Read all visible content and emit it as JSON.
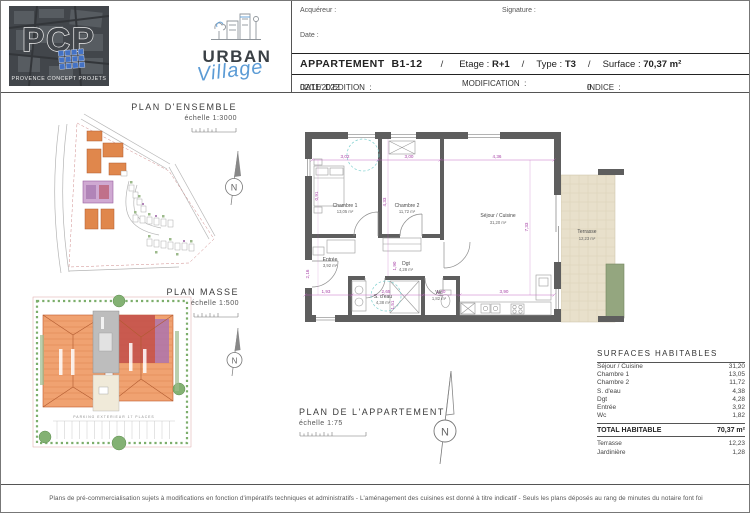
{
  "header": {
    "acquereur_label": "Acquéreur :",
    "signature_label": "Signature :",
    "date_label": "Date :",
    "apt": {
      "label": "APPARTEMENT  B1-12",
      "sep": "/",
      "etage_label": "Etage : ",
      "etage_value": "R+1",
      "type_label": "Type : ",
      "type_value": "T3",
      "surface_label": "Surface : ",
      "surface_value": "70,37 m²"
    },
    "edition": {
      "date_edition_label": "DATE  D'EDITION  : ",
      "date_edition_value": "02/11/2022",
      "modification_label": "MODIFICATION  :",
      "indice_label": "INDICE  : ",
      "indice_value": "0"
    }
  },
  "logos": {
    "pcp": {
      "letters": "PCP",
      "subtitle": "PROVENCE CONCEPT PROJETS"
    },
    "urban": {
      "line1": "URBAN",
      "line2": "Village"
    }
  },
  "plans": {
    "north_letter": "N",
    "ensemble": {
      "title": "PLAN D'ENSEMBLE",
      "scale": "échelle  1:3000"
    },
    "masse": {
      "title": "PLAN MASSE",
      "scale": "échelle  1:500",
      "parking": "PARKING  EXTERIEUR  17  PLACES"
    },
    "appartement": {
      "title": "PLAN DE L'APPARTEMENT",
      "scale": "échelle  1:75"
    }
  },
  "floorplan": {
    "rooms": [
      {
        "name": "Chambre 1",
        "area": "13,05 m²"
      },
      {
        "name": "Chambre 2",
        "area": "11,72 m²"
      },
      {
        "name": "Séjour / Cuisine",
        "area": "31,20 m²"
      },
      {
        "name": "Entrée",
        "area": "3,92 m²"
      },
      {
        "name": "Dgt",
        "area": "4,28 m²"
      },
      {
        "name": "S. d'eau",
        "area": "4,38 m²"
      },
      {
        "name": "Wc",
        "area": "1,82 m²"
      },
      {
        "name": "Terrasse",
        "area": "12,23 m²"
      }
    ],
    "dims": {
      "top": [
        "3,02",
        "3,00",
        "4,36"
      ],
      "bottom": [
        "1,93",
        "2,65",
        "1,40",
        "3,90"
      ],
      "vertical": [
        "0,91",
        "2,16",
        "1,90",
        "4,33",
        "1,51",
        "7,33"
      ]
    }
  },
  "surfaces_table": {
    "title": "SURFACES HABITABLES",
    "rows": [
      {
        "label": "Séjour / Cuisine",
        "value": "31,20"
      },
      {
        "label": "Chambre 1",
        "value": "13,05"
      },
      {
        "label": "Chambre 2",
        "value": "11,72"
      },
      {
        "label": "S. d'eau",
        "value": "4,38"
      },
      {
        "label": "Dgt",
        "value": "4,28"
      },
      {
        "label": "Entrée",
        "value": "3,92"
      },
      {
        "label": "Wc",
        "value": "1,82"
      }
    ],
    "total_label": "TOTAL HABITABLE",
    "total_value": "70,37 m²",
    "annex": [
      {
        "label": "Terrasse",
        "value": "12,23"
      },
      {
        "label": "Jardinière",
        "value": "1,28"
      }
    ]
  },
  "footer": {
    "disclaimer": "Plans de pré-commercialisation sujets à modifications en fonction d'impératifs techniques et administratifs  -  L'aménagement des cuisines est donné à titre indicatif  -  Seuls les plans déposés au rang de minutes du notaire font foi"
  },
  "colors": {
    "wall_gray": "#5e5e5e",
    "dimension_magenta": "#b65cb6",
    "terrace_beige": "#e8e0cb",
    "planter_green": "#94a67f",
    "building_orange": "#f0a271",
    "highlight_red": "#c4524b",
    "highlight_purple": "#ad74ad",
    "pcp_blue": "#4472c4",
    "village_blue": "#5b9bd5"
  }
}
